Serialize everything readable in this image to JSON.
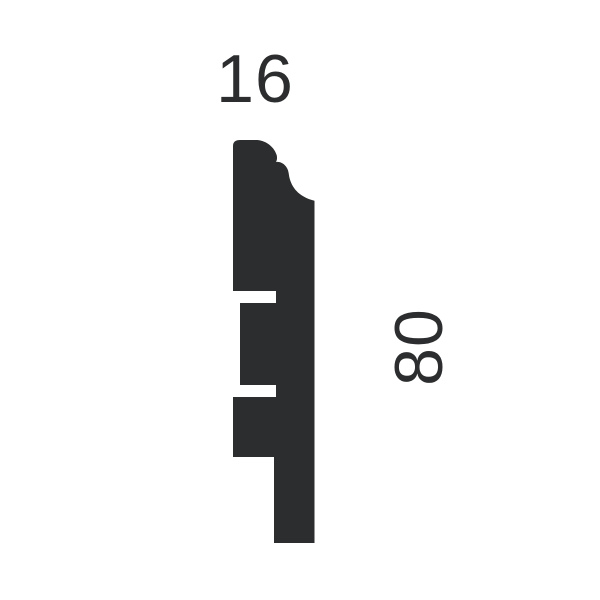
{
  "page": {
    "background_color": "#ffffff"
  },
  "diagram": {
    "kind": "moulding-profile-cross-section",
    "silhouette_color": "#2c2d2e",
    "label_color": "#2c2d2e",
    "width_label": "16",
    "height_label": "80",
    "viewbox": "0 0 600 600",
    "profile_path": "M233,146 Q233,140 240,140 L257.5,140 C267,141 274.5,147.5 276.8,155.5 C277.5,159.5 276.3,161.2 276,162 C280.5,161.2 285.9,164.4 287.9,170 C288.7,172.6 288.9,174.8 289.3,177 C291.6,187 298,196.5 314.5,200.8 L314.5,543 L274,543 L274,457 L233,457 L233,397 L276,397 L276,385 L240,385 L240,303 L276,303 L276,291 L233,291 Z"
  }
}
